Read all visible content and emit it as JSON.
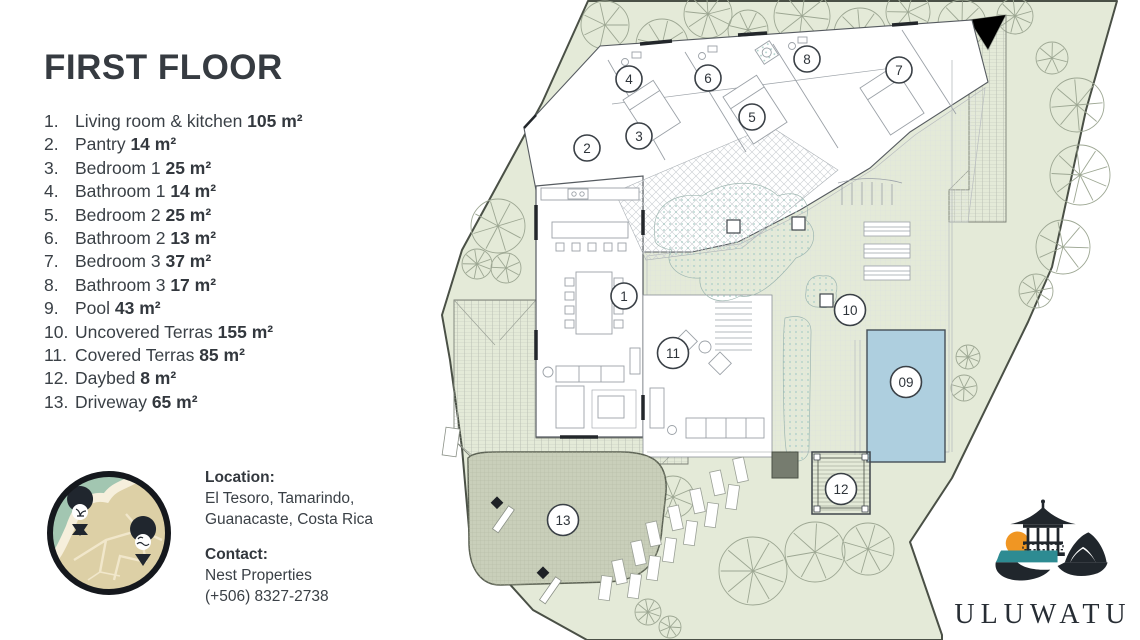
{
  "title": "FIRST FLOOR",
  "legend": [
    {
      "num": "1.",
      "name": "Living room & kitchen",
      "area": "105 m²"
    },
    {
      "num": "2.",
      "name": "Pantry",
      "area": "14 m²"
    },
    {
      "num": "3.",
      "name": "Bedroom 1",
      "area": "25 m²"
    },
    {
      "num": "4.",
      "name": "Bathroom 1",
      "area": "14 m²"
    },
    {
      "num": "5.",
      "name": "Bedroom 2",
      "area": "25 m²"
    },
    {
      "num": "6.",
      "name": "Bathroom 2",
      "area": "13 m²"
    },
    {
      "num": "7.",
      "name": "Bedroom 3",
      "area": "37 m²"
    },
    {
      "num": "8.",
      "name": "Bathroom 3",
      "area": "17 m²"
    },
    {
      "num": "9.",
      "name": "Pool",
      "area": "43 m²"
    },
    {
      "num": "10.",
      "name": "Uncovered Terras",
      "area": "155 m²"
    },
    {
      "num": "11.",
      "name": "Covered Terras",
      "area": "85 m²"
    },
    {
      "num": "12.",
      "name": "Daybed",
      "area": "8 m²"
    },
    {
      "num": "13.",
      "name": "Driveway",
      "area": "65 m²"
    }
  ],
  "info": {
    "location_label": "Location:",
    "location1": "El Tesoro, Tamarindo,",
    "location2": "Guanacaste, Costa Rica",
    "contact_label": "Contact:",
    "contact1": "Nest Properties",
    "contact2": "(+506) 8327-2738"
  },
  "brand": "ULUWATU",
  "plan_badges": [
    "1",
    "2",
    "3",
    "4",
    "5",
    "6",
    "7",
    "8",
    "09",
    "10",
    "11",
    "12",
    "13"
  ],
  "colors": {
    "lot_green": "#e4ead8",
    "tree_line": "#9da793",
    "pool_blue": "#aecfdf",
    "driveway": "#c9cfba",
    "stipple_dot": "#a9cdc6",
    "ink": "#363b41",
    "logo_teal": "#2d8b92",
    "logo_sun": "#f09623",
    "logo_dark": "#20262c"
  }
}
